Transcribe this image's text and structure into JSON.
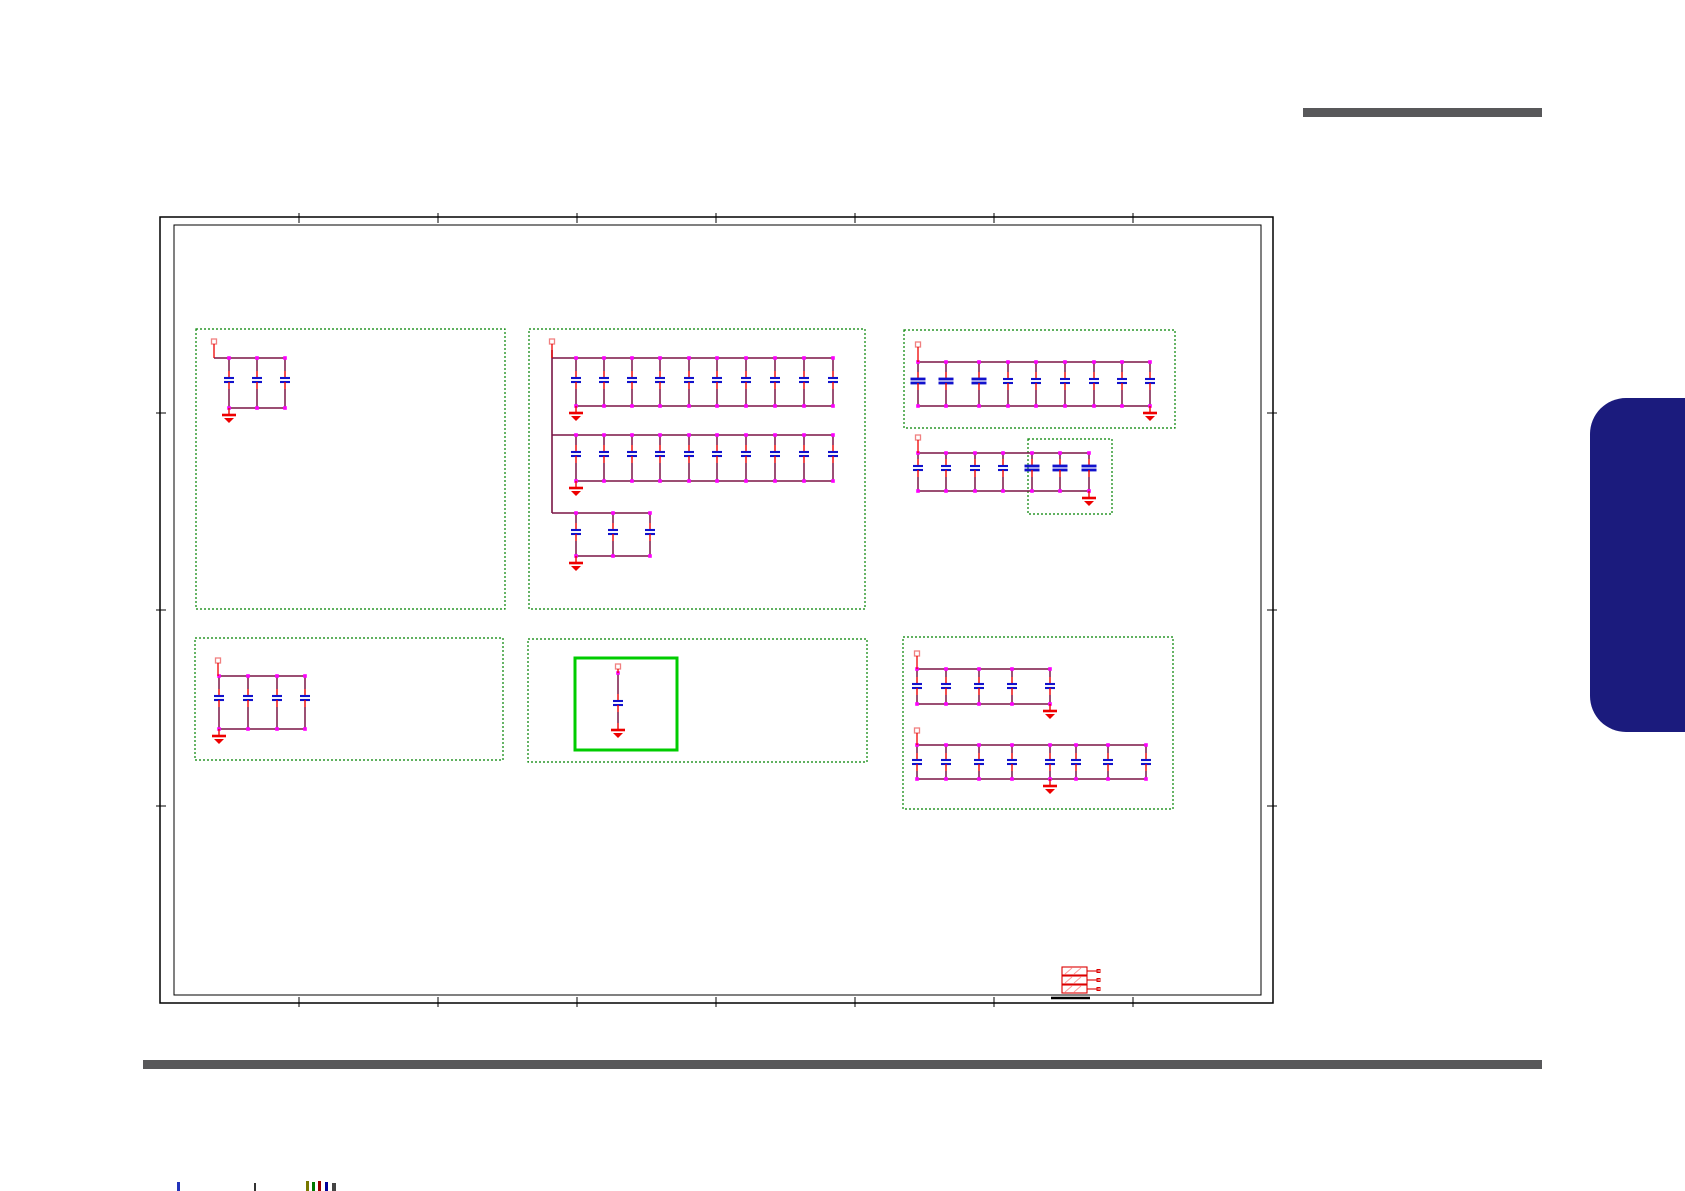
{
  "page": {
    "width": 1685,
    "height": 1191,
    "background": "#ffffff"
  },
  "colors": {
    "wire": "#7a1545",
    "junction": "#ff00ff",
    "plate": "#1111cc",
    "lead": "#ee0000",
    "pin_outline": "#f08080",
    "ground": "#ee0000",
    "box_dashed": "#008200",
    "box_highlight": "#00cc00",
    "border": "#000000",
    "rule": "#58585a",
    "tab": "#1b1b7d",
    "connector": "#dd0000",
    "connector_hatch": "#ff9999"
  },
  "decor": {
    "header_rule": {
      "x": 1303,
      "y": 108,
      "width": 239,
      "height": 9
    },
    "footer_rule": {
      "x": 143,
      "y": 1060,
      "width": 1399,
      "height": 9
    },
    "side_tab": {
      "x": 1590,
      "y": 398,
      "width": 95,
      "height": 334
    }
  },
  "sheet": {
    "outer": {
      "x": 160,
      "y": 217,
      "width": 1113,
      "height": 786
    },
    "inner": {
      "x": 174,
      "y": 225,
      "width": 1087,
      "height": 770
    },
    "zone_ticks_x": [
      299,
      438,
      577,
      716,
      855,
      994,
      1133
    ],
    "zone_ticks_y": [
      413,
      610,
      806
    ]
  },
  "group_boxes": [
    {
      "id": "box-1",
      "x": 196,
      "y": 329,
      "width": 309,
      "height": 280,
      "style": "dashed"
    },
    {
      "id": "box-2",
      "x": 529,
      "y": 329,
      "width": 336,
      "height": 280,
      "style": "dashed"
    },
    {
      "id": "box-3",
      "x": 904,
      "y": 330,
      "width": 271,
      "height": 98,
      "style": "dashed"
    },
    {
      "id": "box-4",
      "x": 1028,
      "y": 439,
      "width": 84,
      "height": 75,
      "style": "dashed"
    },
    {
      "id": "box-5",
      "x": 195,
      "y": 638,
      "width": 308,
      "height": 122,
      "style": "dashed"
    },
    {
      "id": "box-6",
      "x": 528,
      "y": 639,
      "width": 339,
      "height": 123,
      "style": "dashed"
    },
    {
      "id": "box-6-highlight",
      "x": 575,
      "y": 658,
      "width": 102,
      "height": 92,
      "style": "solid"
    },
    {
      "id": "box-7",
      "x": 903,
      "y": 637,
      "width": 270,
      "height": 172,
      "style": "dashed"
    }
  ],
  "cap_banks": [
    {
      "id": "bank-1",
      "cap_count": 3,
      "pin": {
        "x": 214,
        "y": 345
      },
      "rail": {
        "x1": 214,
        "x2": 286,
        "y": 358
      },
      "caps": [
        229,
        257,
        285
      ],
      "plate_y": 378,
      "bottom": {
        "x1": 229,
        "x2": 286,
        "y": 408
      },
      "ground": {
        "x": 229,
        "y": 408
      }
    },
    {
      "id": "bank-2a",
      "cap_count": 10,
      "pin": {
        "x": 552,
        "y": 345
      },
      "drop": {
        "x": 552,
        "y1": 350,
        "y2": 513
      },
      "rail": {
        "x1": 552,
        "x2": 833,
        "y": 358
      },
      "caps": [
        576,
        604,
        632,
        660,
        689,
        717,
        746,
        775,
        804,
        833
      ],
      "plate_y": 378,
      "bottom": {
        "x1": 576,
        "x2": 833,
        "y": 406
      },
      "ground": {
        "x": 576,
        "y": 406
      }
    },
    {
      "id": "bank-2b",
      "cap_count": 10,
      "rail": {
        "x1": 552,
        "x2": 833,
        "y": 435
      },
      "caps": [
        576,
        604,
        632,
        660,
        689,
        717,
        746,
        775,
        804,
        833
      ],
      "plate_y": 452,
      "bottom": {
        "x1": 576,
        "x2": 833,
        "y": 481
      },
      "ground": {
        "x": 576,
        "y": 481
      }
    },
    {
      "id": "bank-2c",
      "cap_count": 3,
      "rail": {
        "x1": 552,
        "x2": 650,
        "y": 513
      },
      "caps": [
        576,
        613,
        650
      ],
      "plate_y": 530,
      "bottom": {
        "x1": 576,
        "x2": 650,
        "y": 556
      },
      "ground": {
        "x": 576,
        "y": 556
      }
    },
    {
      "id": "bank-3",
      "cap_count": 9,
      "pin": {
        "x": 918,
        "y": 348
      },
      "rail": {
        "x1": 918,
        "x2": 1150,
        "y": 362
      },
      "caps": [
        918,
        946,
        979,
        1008,
        1036,
        1065,
        1094,
        1122,
        1150
      ],
      "wide": [
        0,
        1,
        2
      ],
      "plate_y": 379,
      "bottom": {
        "x1": 918,
        "x2": 1150,
        "y": 406
      },
      "ground": {
        "x": 1150,
        "y": 406
      }
    },
    {
      "id": "bank-4",
      "cap_count": 7,
      "pin": {
        "x": 918,
        "y": 441
      },
      "rail": {
        "x1": 918,
        "x2": 1089,
        "y": 453
      },
      "caps": [
        918,
        946,
        975,
        1003,
        1032,
        1060,
        1089
      ],
      "wide": [
        4,
        5,
        6
      ],
      "plate_y": 466,
      "bottom": {
        "x1": 918,
        "x2": 1089,
        "y": 491
      },
      "ground": {
        "x": 1089,
        "y": 491
      }
    },
    {
      "id": "bank-5",
      "cap_count": 4,
      "pin": {
        "x": 218,
        "y": 664
      },
      "rail": {
        "x1": 218,
        "x2": 305,
        "y": 676
      },
      "caps": [
        219,
        248,
        277,
        305
      ],
      "plate_y": 696,
      "bottom": {
        "x1": 219,
        "x2": 305,
        "y": 729
      },
      "ground": {
        "x": 219,
        "y": 729
      }
    },
    {
      "id": "bank-6",
      "cap_count": 1,
      "pin": {
        "x": 618,
        "y": 670
      },
      "caps": [
        618
      ],
      "plate_y": 701,
      "ground": {
        "x": 618,
        "y": 723
      }
    },
    {
      "id": "bank-7a",
      "cap_count": 5,
      "pin": {
        "x": 917,
        "y": 657
      },
      "rail": {
        "x1": 917,
        "x2": 1050,
        "y": 669
      },
      "caps": [
        917,
        946,
        979,
        1012,
        1050
      ],
      "plate_y": 684,
      "bottom": {
        "x1": 917,
        "x2": 1050,
        "y": 704
      },
      "ground": {
        "x": 1050,
        "y": 704
      }
    },
    {
      "id": "bank-7b",
      "cap_count": 8,
      "pin": {
        "x": 917,
        "y": 734
      },
      "rail": {
        "x1": 917,
        "x2": 1146,
        "y": 745
      },
      "caps": [
        917,
        946,
        979,
        1012,
        1050,
        1076,
        1108,
        1146
      ],
      "plate_y": 760,
      "bottom": {
        "x1": 917,
        "x2": 1146,
        "y": 779
      },
      "ground": {
        "x": 1050,
        "y": 779
      }
    }
  ],
  "connector": {
    "x": 1062,
    "y": 967,
    "rows": 3,
    "row_width": 25,
    "row_height": 8,
    "row_gap": 1,
    "pin_length": 12,
    "underline": {
      "x1": 1051,
      "x2": 1090,
      "y": 998
    }
  },
  "footer_marks": [
    {
      "x": 177,
      "y": 1182,
      "w": 3,
      "h": 9,
      "color": "#2233bb"
    },
    {
      "x": 254,
      "y": 1183,
      "w": 2,
      "h": 8,
      "color": "#333333"
    },
    {
      "x": 306,
      "y": 1181,
      "w": 3,
      "h": 10,
      "color": "#777700"
    },
    {
      "x": 312,
      "y": 1182,
      "w": 3,
      "h": 9,
      "color": "#007700"
    },
    {
      "x": 318,
      "y": 1181,
      "w": 3,
      "h": 10,
      "color": "#990000"
    },
    {
      "x": 325,
      "y": 1182,
      "w": 3,
      "h": 9,
      "color": "#000099"
    },
    {
      "x": 332,
      "y": 1183,
      "w": 4,
      "h": 8,
      "color": "#444444"
    }
  ]
}
